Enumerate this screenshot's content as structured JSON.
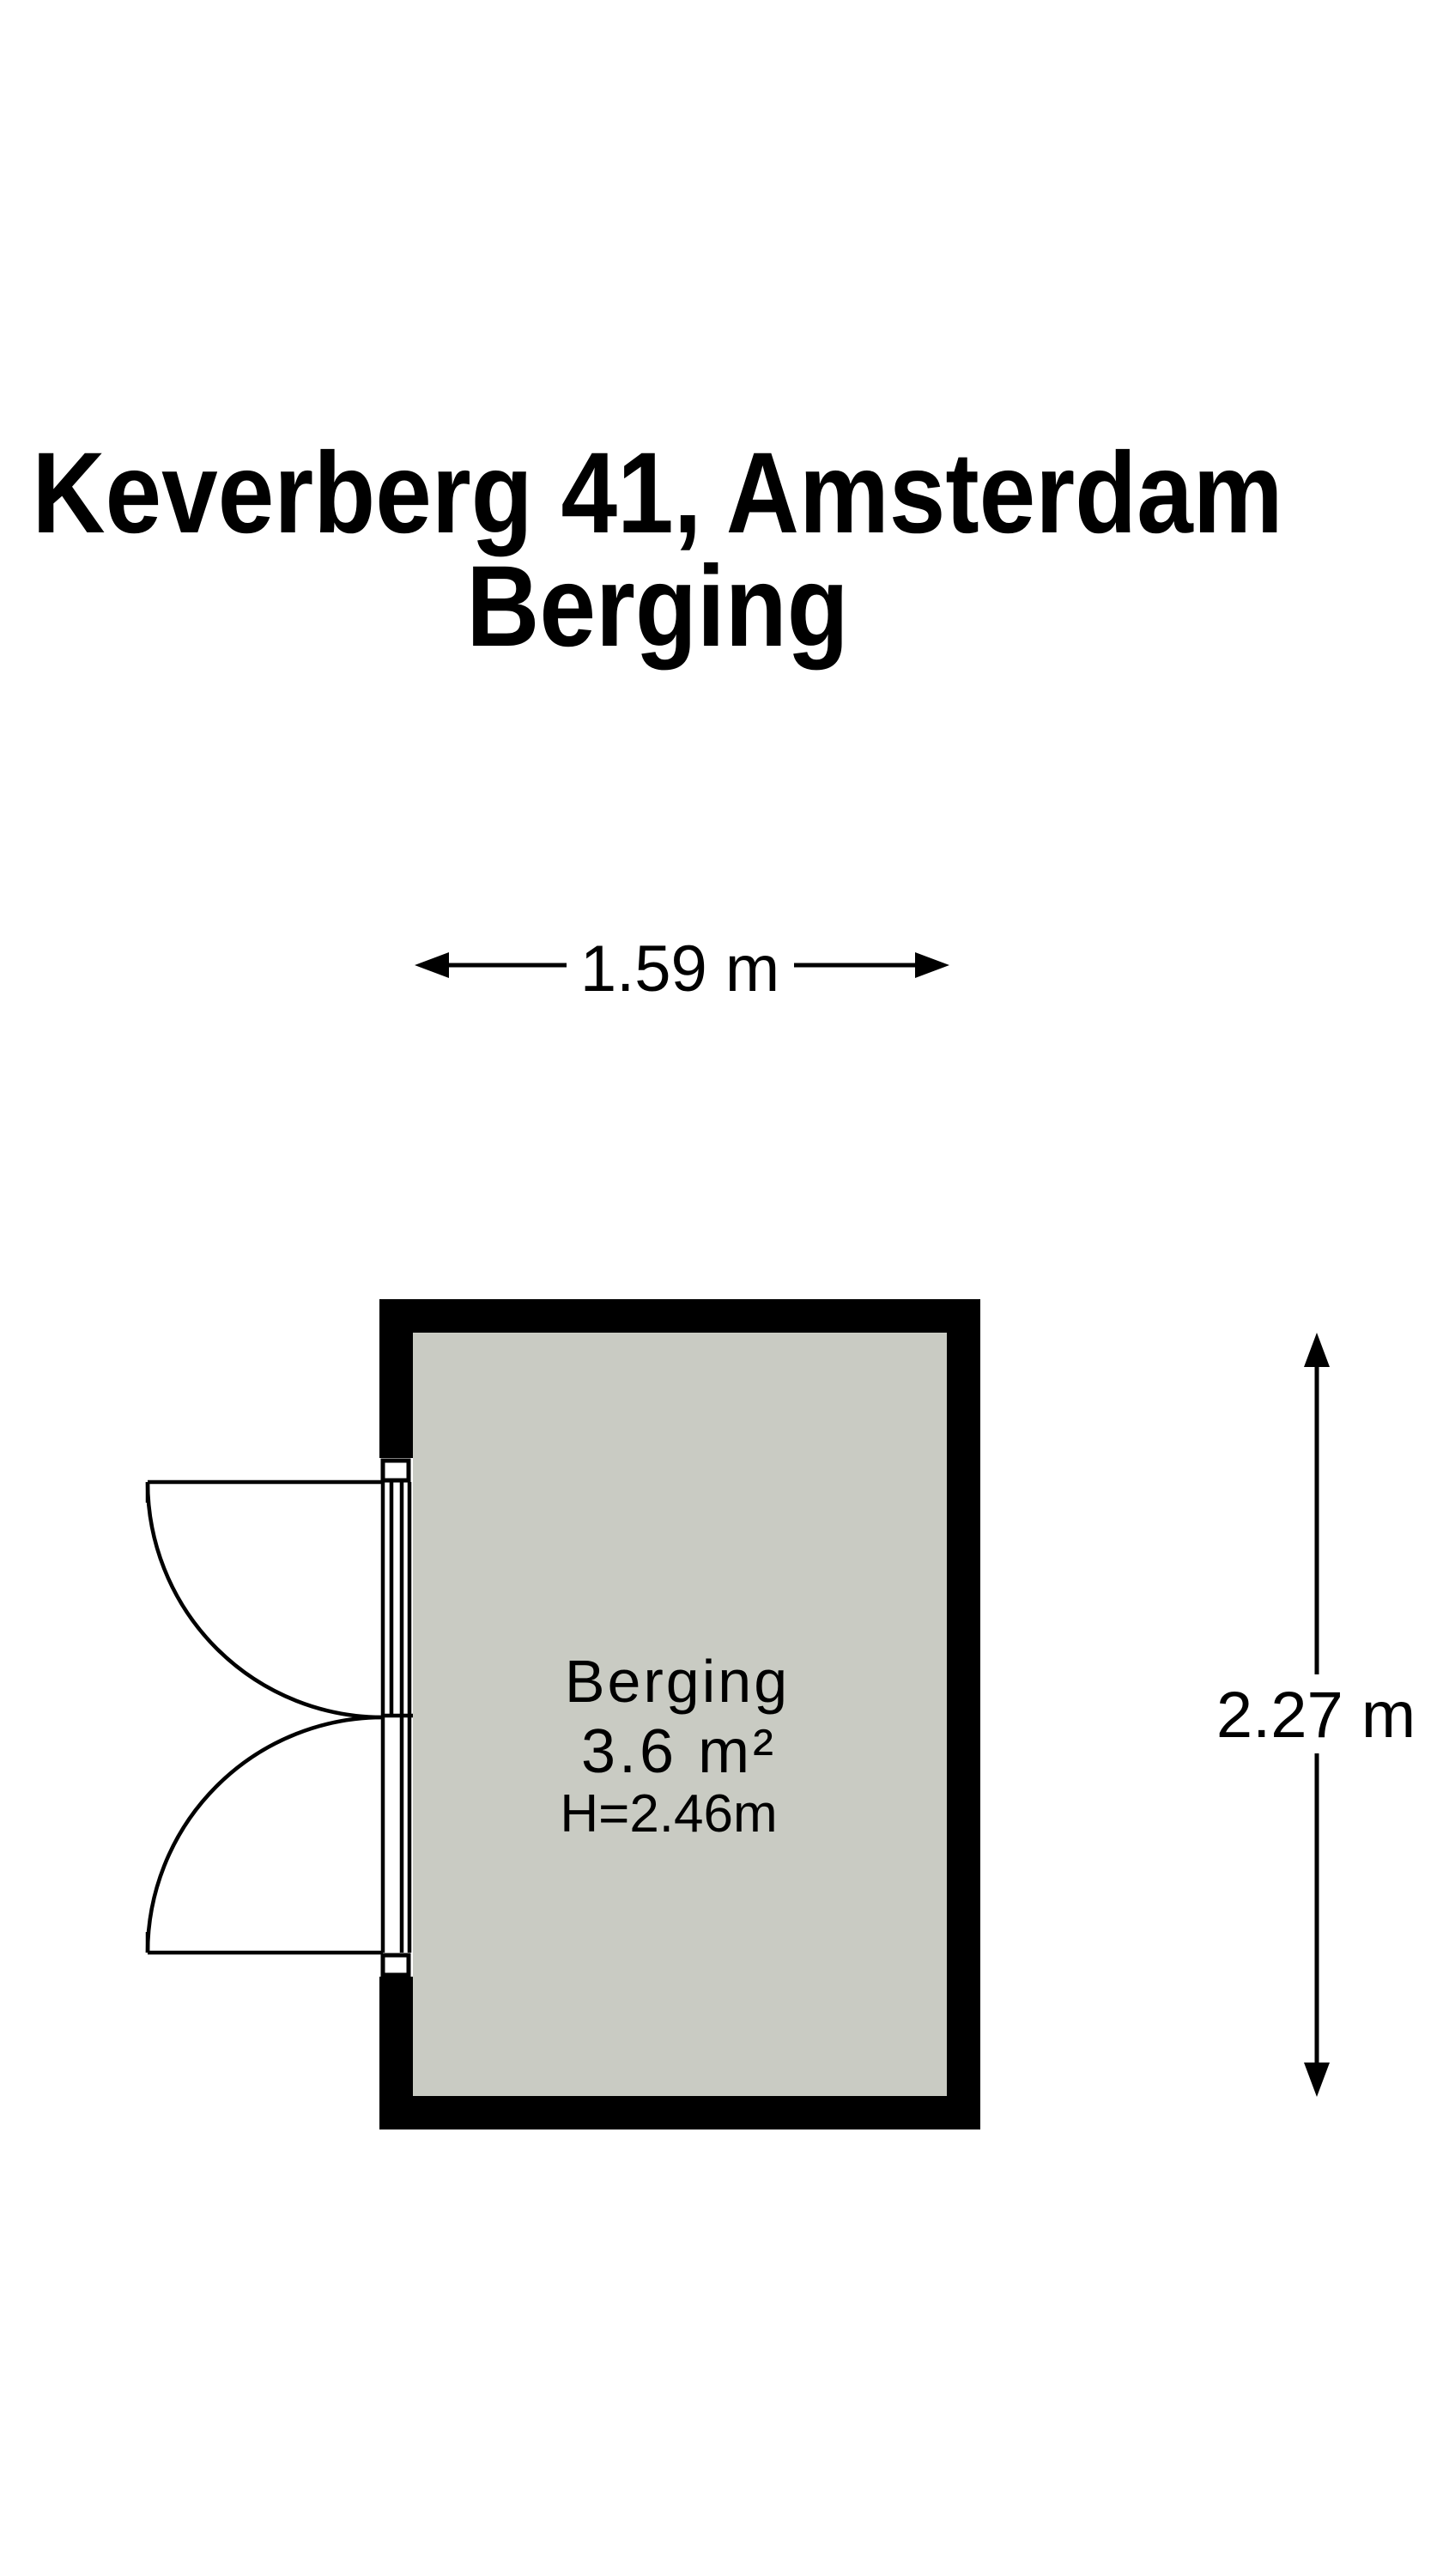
{
  "title": {
    "line1": "Keverberg 41, Amsterdam",
    "line2": "Berging"
  },
  "dimensions": {
    "width_label": "1.59 m",
    "height_label": "2.27 m"
  },
  "room": {
    "name": "Berging",
    "area": "3.6 m²",
    "ceiling_height": "H=2.46m"
  },
  "colors": {
    "wall": "#000000",
    "floor": "#c9cbc3",
    "background": "#ffffff",
    "text": "#000000"
  }
}
